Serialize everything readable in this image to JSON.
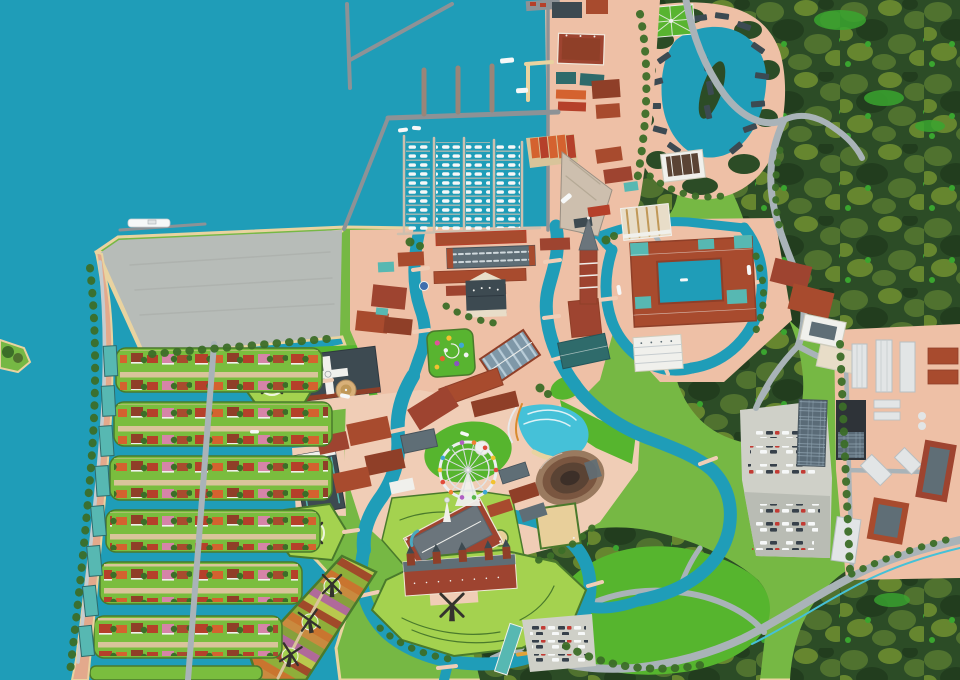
{
  "map": {
    "kind": "illustrated-aerial-resort-map",
    "theme": "dutch-canal-town-theme-park",
    "visible_text": [],
    "regions": [
      "open-sea",
      "harbor-bay",
      "marina",
      "breakwaters",
      "waterfront-district",
      "old-town",
      "cathedral-tower",
      "town-hall",
      "market-hall",
      "glass-arcade",
      "flower-garden",
      "hotel-courtyard-complex",
      "white-hall",
      "east-apartments",
      "cross-roof-church",
      "dome-tower",
      "theatre-hall",
      "amusement-park",
      "ferris-wheel",
      "wave-pool",
      "amphitheater",
      "art-garden-palace",
      "sand-court",
      "castle-fort-island",
      "flower-fields",
      "windmill-bastions",
      "residential-islands",
      "left-bank-strip",
      "vacant-field",
      "forest",
      "forest-villa-lagoon",
      "formal-garden",
      "lagoon-hall",
      "industrial-park",
      "main-parking-lot",
      "solar-array",
      "small-parking-lot",
      "lawn-park",
      "highway",
      "forest-roads",
      "canals",
      "bridges",
      "southwest-islet"
    ],
    "counts": {
      "windmills": 6,
      "marina_boat_docks": 4,
      "residential_island_rows": 7,
      "left_bank_buildings": 8,
      "ferris_wheel_cabins": 14,
      "flower_field_windmills": 3,
      "windmill_bastion_pads": 2
    }
  },
  "palette": {
    "water": "#1f9db8",
    "waterLight": "#45c1d8",
    "foam": "#dff2f6",
    "sand": "#e9d3a0",
    "land": "#76b844",
    "lawn": "#56b52e",
    "lawnPale": "#a4d24f",
    "island": "#7abd3e",
    "garden": "#58b430",
    "forest": "#2c4c26",
    "forestL": "#50722f",
    "forestO": "#66862f",
    "forestD": "#223d1e",
    "forestB": "#3aa52f",
    "tree": "#3c6e28",
    "hedge": "#4a7a2c",
    "salmon": "#eec0a6",
    "salmonD": "#e3a98c",
    "plaza": "#f0cdb6",
    "pathTan": "#d9c49a",
    "gravel": "#b7bcb8",
    "parking": "#cfd0c8",
    "parkingD": "#b9bcb4",
    "pier": "#8d9296",
    "dock": "#cdbfae",
    "road": "#a9b3b8",
    "roadL": "#c6cccf",
    "brick": "#a84b2e",
    "brickD": "#8f3f28",
    "brickR": "#9e4430",
    "roofRed": "#b5402a",
    "roofOr": "#d4622f",
    "roofPink": "#d684a8",
    "roofDark": "#3d4a51",
    "roofSlate": "#5f6e76",
    "roofGray": "#6b757c",
    "roofTeal": "#57b8b2",
    "tealDeep": "#2f6b6b",
    "cream": "#e8ddc8",
    "white": "#f0f0ec",
    "offWhite": "#e2e5e6",
    "glass": "#7f98a8",
    "glassL": "#b8ccd8",
    "solar": "#5a6b77",
    "solarL": "#8fa3b0",
    "dome": "#d8b078",
    "domeSh": "#c09858",
    "amphRim": "#9a7a5f",
    "amphMid": "#7a5640",
    "amphIn": "#5a4334",
    "amphDark": "#3c2f28",
    "sandC": "#e8cf9a",
    "mill": "#34322e",
    "boat": "#f6f8f8",
    "carD": "#37414b",
    "carR": "#c23b34",
    "factory": "#2e3338",
    "blue": "#3f6fae",
    "orangeBoat": "#e0a23a",
    "cottage": "#3c4a52",
    "cab1": "#e04a3a",
    "cab2": "#f2c230",
    "cab3": "#3fa7d6",
    "cab4": "#58b84a",
    "cab5": "#b05fc2",
    "cab6": "#f08030"
  }
}
